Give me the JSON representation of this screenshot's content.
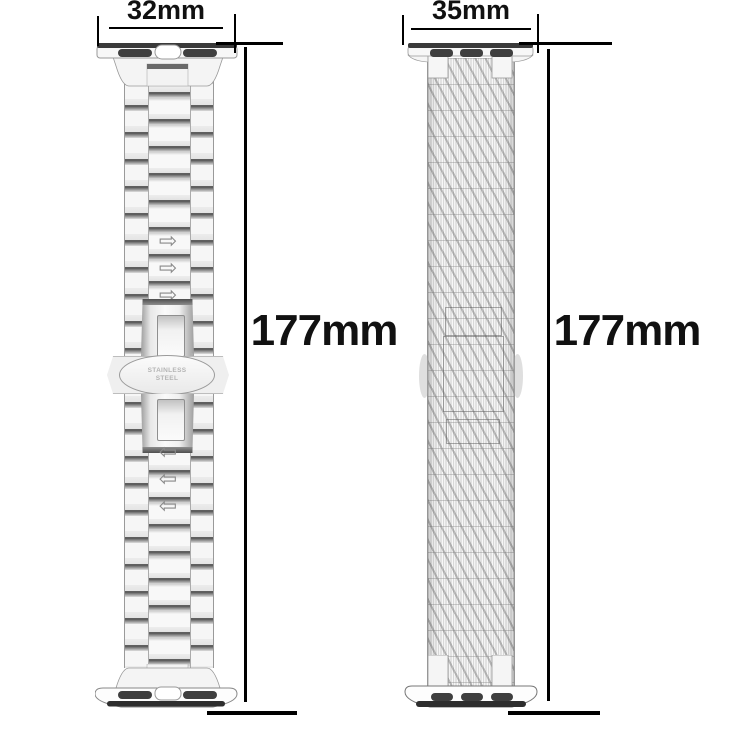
{
  "diagram": {
    "description_left": "stainless steel link watch band",
    "description_right": "woven mesh watch band"
  },
  "annotations": {
    "left": {
      "width": "32mm",
      "length": "177mm"
    },
    "right": {
      "width": "35mm",
      "length": "177mm"
    }
  },
  "left_band": {
    "engraving_line1": "STAINLESS",
    "engraving_line2": "STEEL",
    "arrow_right_glyph": "⇨",
    "arrow_left_glyph": "⇦"
  },
  "colors": {
    "background": "#ffffff",
    "dimension_line": "#000000",
    "band_outline": "#9a9a9a",
    "link_bar_dark": "#5f5f5f",
    "connector_slot": "#3a3a3a",
    "engraving_text": "#b4b4b4"
  }
}
